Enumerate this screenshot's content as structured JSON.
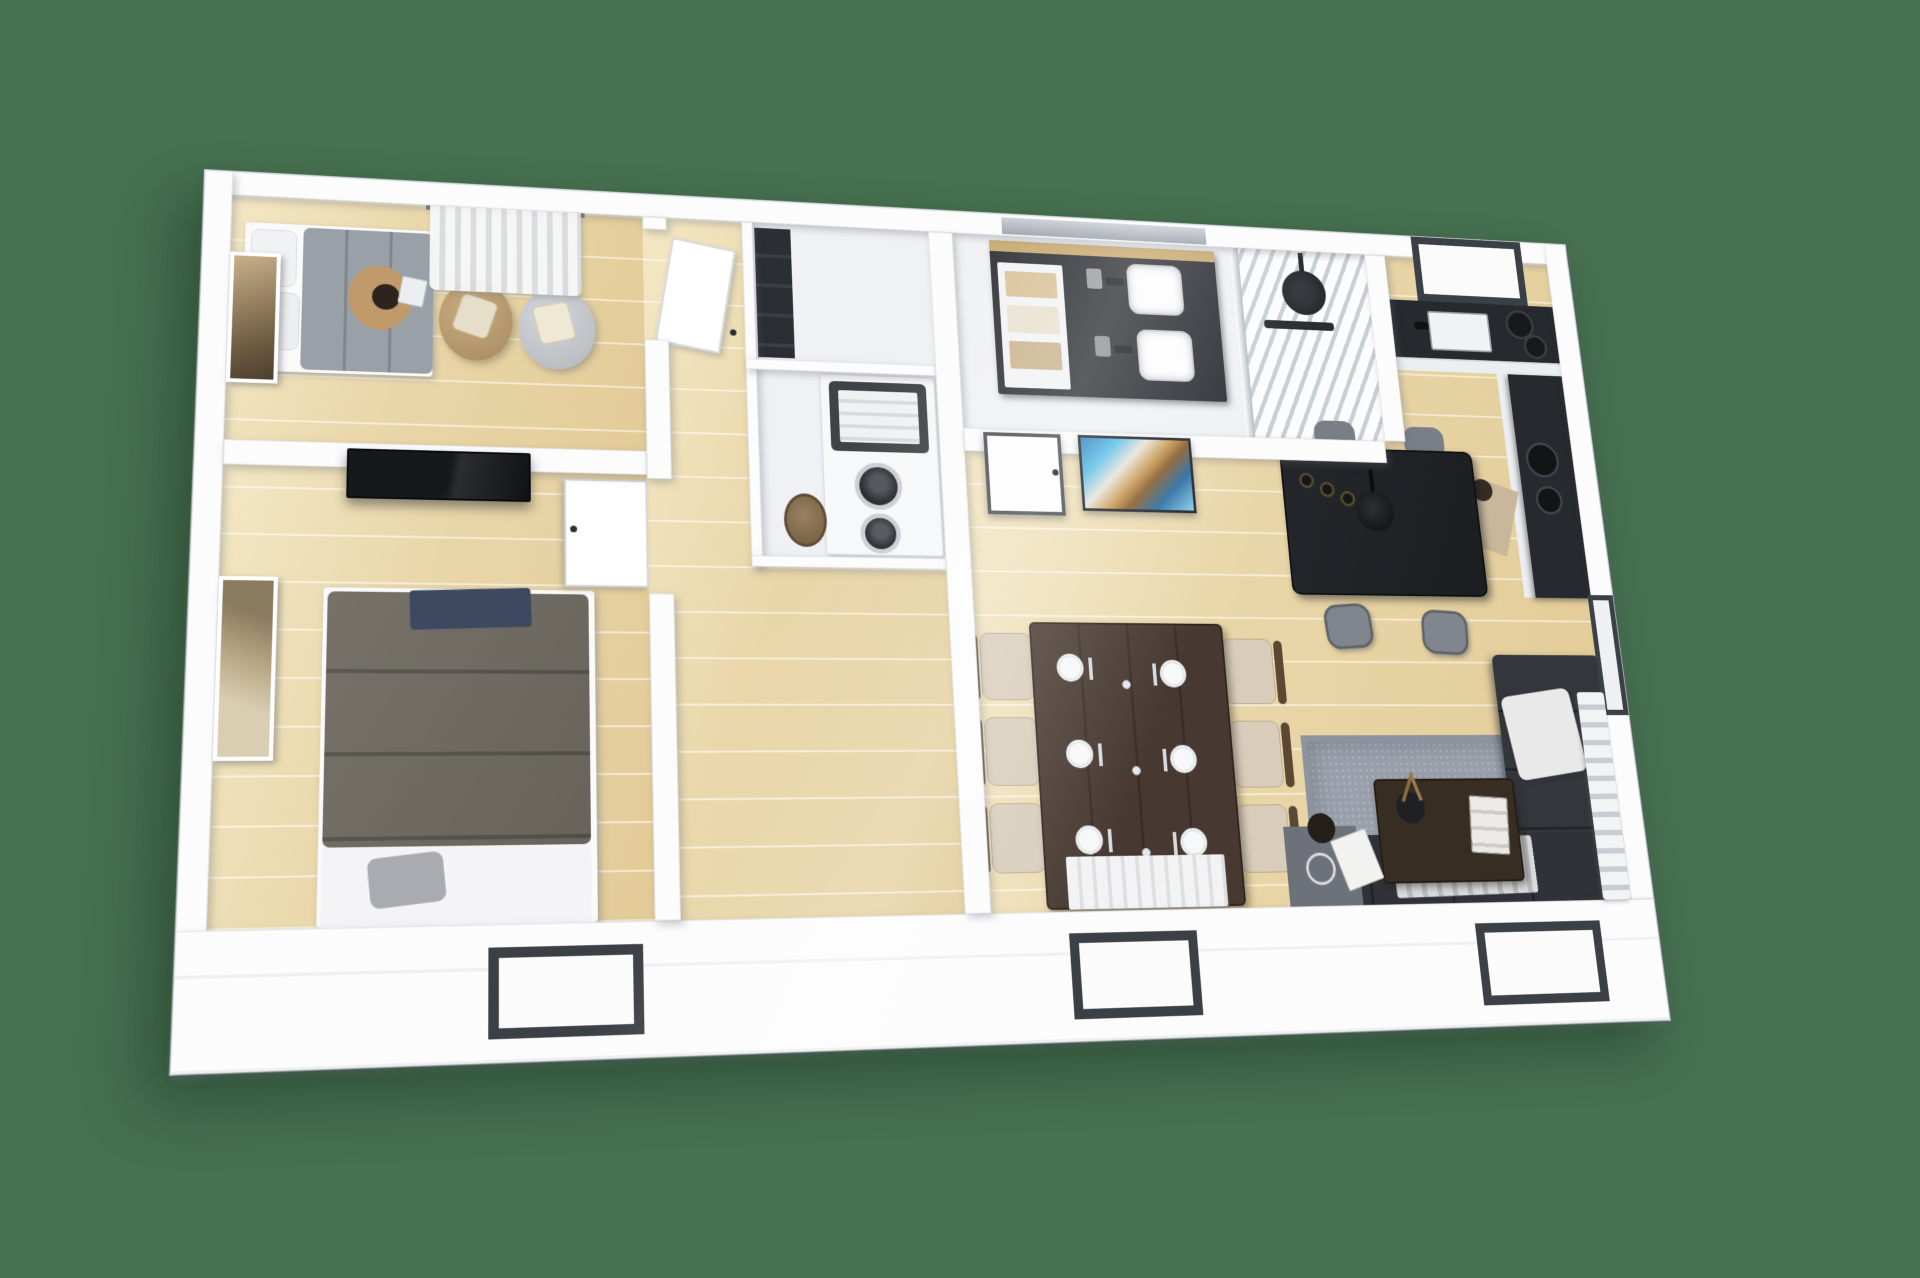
{
  "scene": {
    "kind": "isometric-3d-floor-plan-render",
    "background_color": "#467050",
    "description": "Isometric top-down 3D render of a rectangular single-storey home with two bedrooms, a hallway laundry closet, bathroom with double vanity and walk-in shower, kitchen, bar counter, dining area and living room",
    "people_count": 3,
    "front_wall_window_count": 3
  },
  "palette": {
    "background_green": "#467050",
    "wall_white": "#fcfcfd",
    "floor_wood": "#e9d6a8",
    "counter_dark": "#26292d",
    "sofa_dark": "#33363b",
    "rug_gray": "#9aa0ab",
    "duvet_single": "#9aa0a8",
    "duvet_master": "#6e6a62",
    "dining_wood": "#473931",
    "window_frame": "#3b4046",
    "art_blue": "#3a8fc4",
    "art_sepia": "#b0936a"
  },
  "rooms": [
    {
      "id": "bedroom-1",
      "label": "Bedroom 1",
      "furniture": [
        "single bed with gray duvet",
        "person sitting on bed reading",
        "two bean bag chairs with cushions",
        "sheer curtained window",
        "framed sepia wall art",
        "white door ajar"
      ]
    },
    {
      "id": "bedroom-2",
      "label": "Master bedroom",
      "furniture": [
        "double bed with taupe quilted duvet",
        "navy throw",
        "white sheet and gray pillow",
        "wall-mounted TV",
        "framed tree artwork",
        "white door against wall"
      ]
    },
    {
      "id": "hallway",
      "label": "Hallway and laundry closet",
      "furniture": [
        "stacked washer and dryer",
        "dark towel basket on machine",
        "tall dark shelving cabinet",
        "round wicker hamper"
      ]
    },
    {
      "id": "bathroom",
      "label": "Bathroom",
      "furniture": [
        "dark double vanity with wood trim",
        "two white vessel sinks",
        "open towel shelves",
        "glass partition",
        "walk-in shower with black rain head",
        "marble shower floor",
        "white door",
        "colorful abstract wall art"
      ]
    },
    {
      "id": "kitchen",
      "label": "Kitchen",
      "furniture": [
        "L-shaped dark counter",
        "kitchen sink",
        "cooktop with pans",
        "dark framed back window",
        "person cooking",
        "tall dark side door"
      ]
    },
    {
      "id": "dining",
      "label": "Dining area",
      "furniture": [
        "dark wood dining table set for six",
        "six chairs with beige cushions",
        "white table runner"
      ]
    },
    {
      "id": "bar",
      "label": "Bar counter",
      "furniture": [
        "high dark bar table",
        "black pendant lamp",
        "three storage jars",
        "gray bar stools"
      ]
    },
    {
      "id": "living",
      "label": "Living room",
      "furniture": [
        "gray area rug",
        "dark L-shaped sectional sofa",
        "white throw pillow",
        "striped blanket",
        "dark coffee table",
        "books and vase with dried flowers",
        "person seated reading a magazine",
        "striped right-wall curtain"
      ]
    }
  ]
}
